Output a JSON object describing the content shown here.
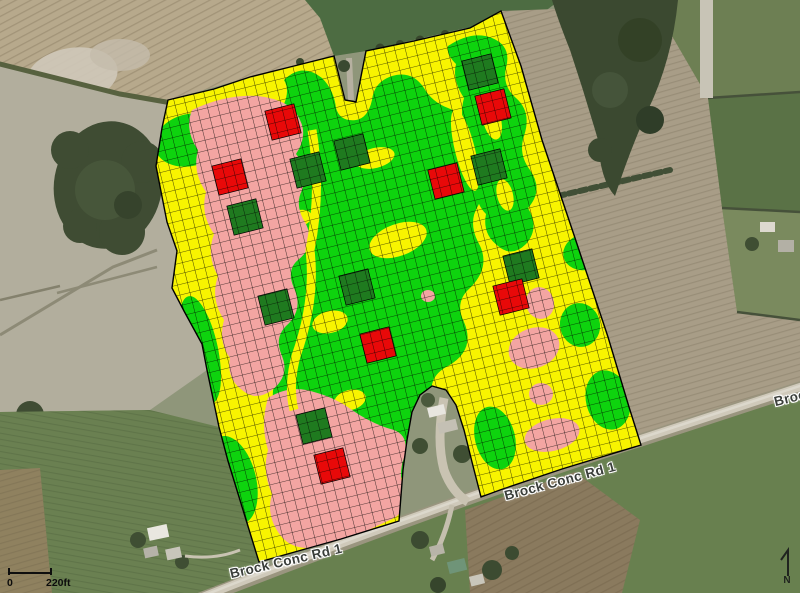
{
  "road_labels": [
    {
      "text": "Brock Conc Rd 1"
    },
    {
      "text": "Brock Conc Rd 1"
    },
    {
      "text": "Brock Conc Rd 1"
    }
  ],
  "scale_bar": {
    "start": "0",
    "end": "220ft"
  },
  "north_indicator": {
    "label": "N"
  },
  "field_overlay": {
    "colors": {
      "zone_yellow": "#F8F400",
      "zone_green": "#0ED30E",
      "zone_pink": "#F3A5A2",
      "marker_red": "#E80909",
      "marker_dark_green": "#1F7A1F",
      "grid_line": "#000000"
    },
    "grid": {
      "cell_size_px": 10.3,
      "rotation_deg": -14
    },
    "markers": {
      "marker_size_px": 30,
      "dark_green": [
        [
          480,
          72
        ],
        [
          352,
          152
        ],
        [
          308,
          170
        ],
        [
          489,
          167
        ],
        [
          245,
          217
        ],
        [
          521,
          267
        ],
        [
          357,
          287
        ],
        [
          276,
          307
        ],
        [
          314,
          426
        ]
      ],
      "red": [
        [
          283,
          122
        ],
        [
          493,
          107
        ],
        [
          230,
          177
        ],
        [
          446,
          181
        ],
        [
          511,
          297
        ],
        [
          378,
          345
        ],
        [
          332,
          466
        ]
      ]
    }
  }
}
